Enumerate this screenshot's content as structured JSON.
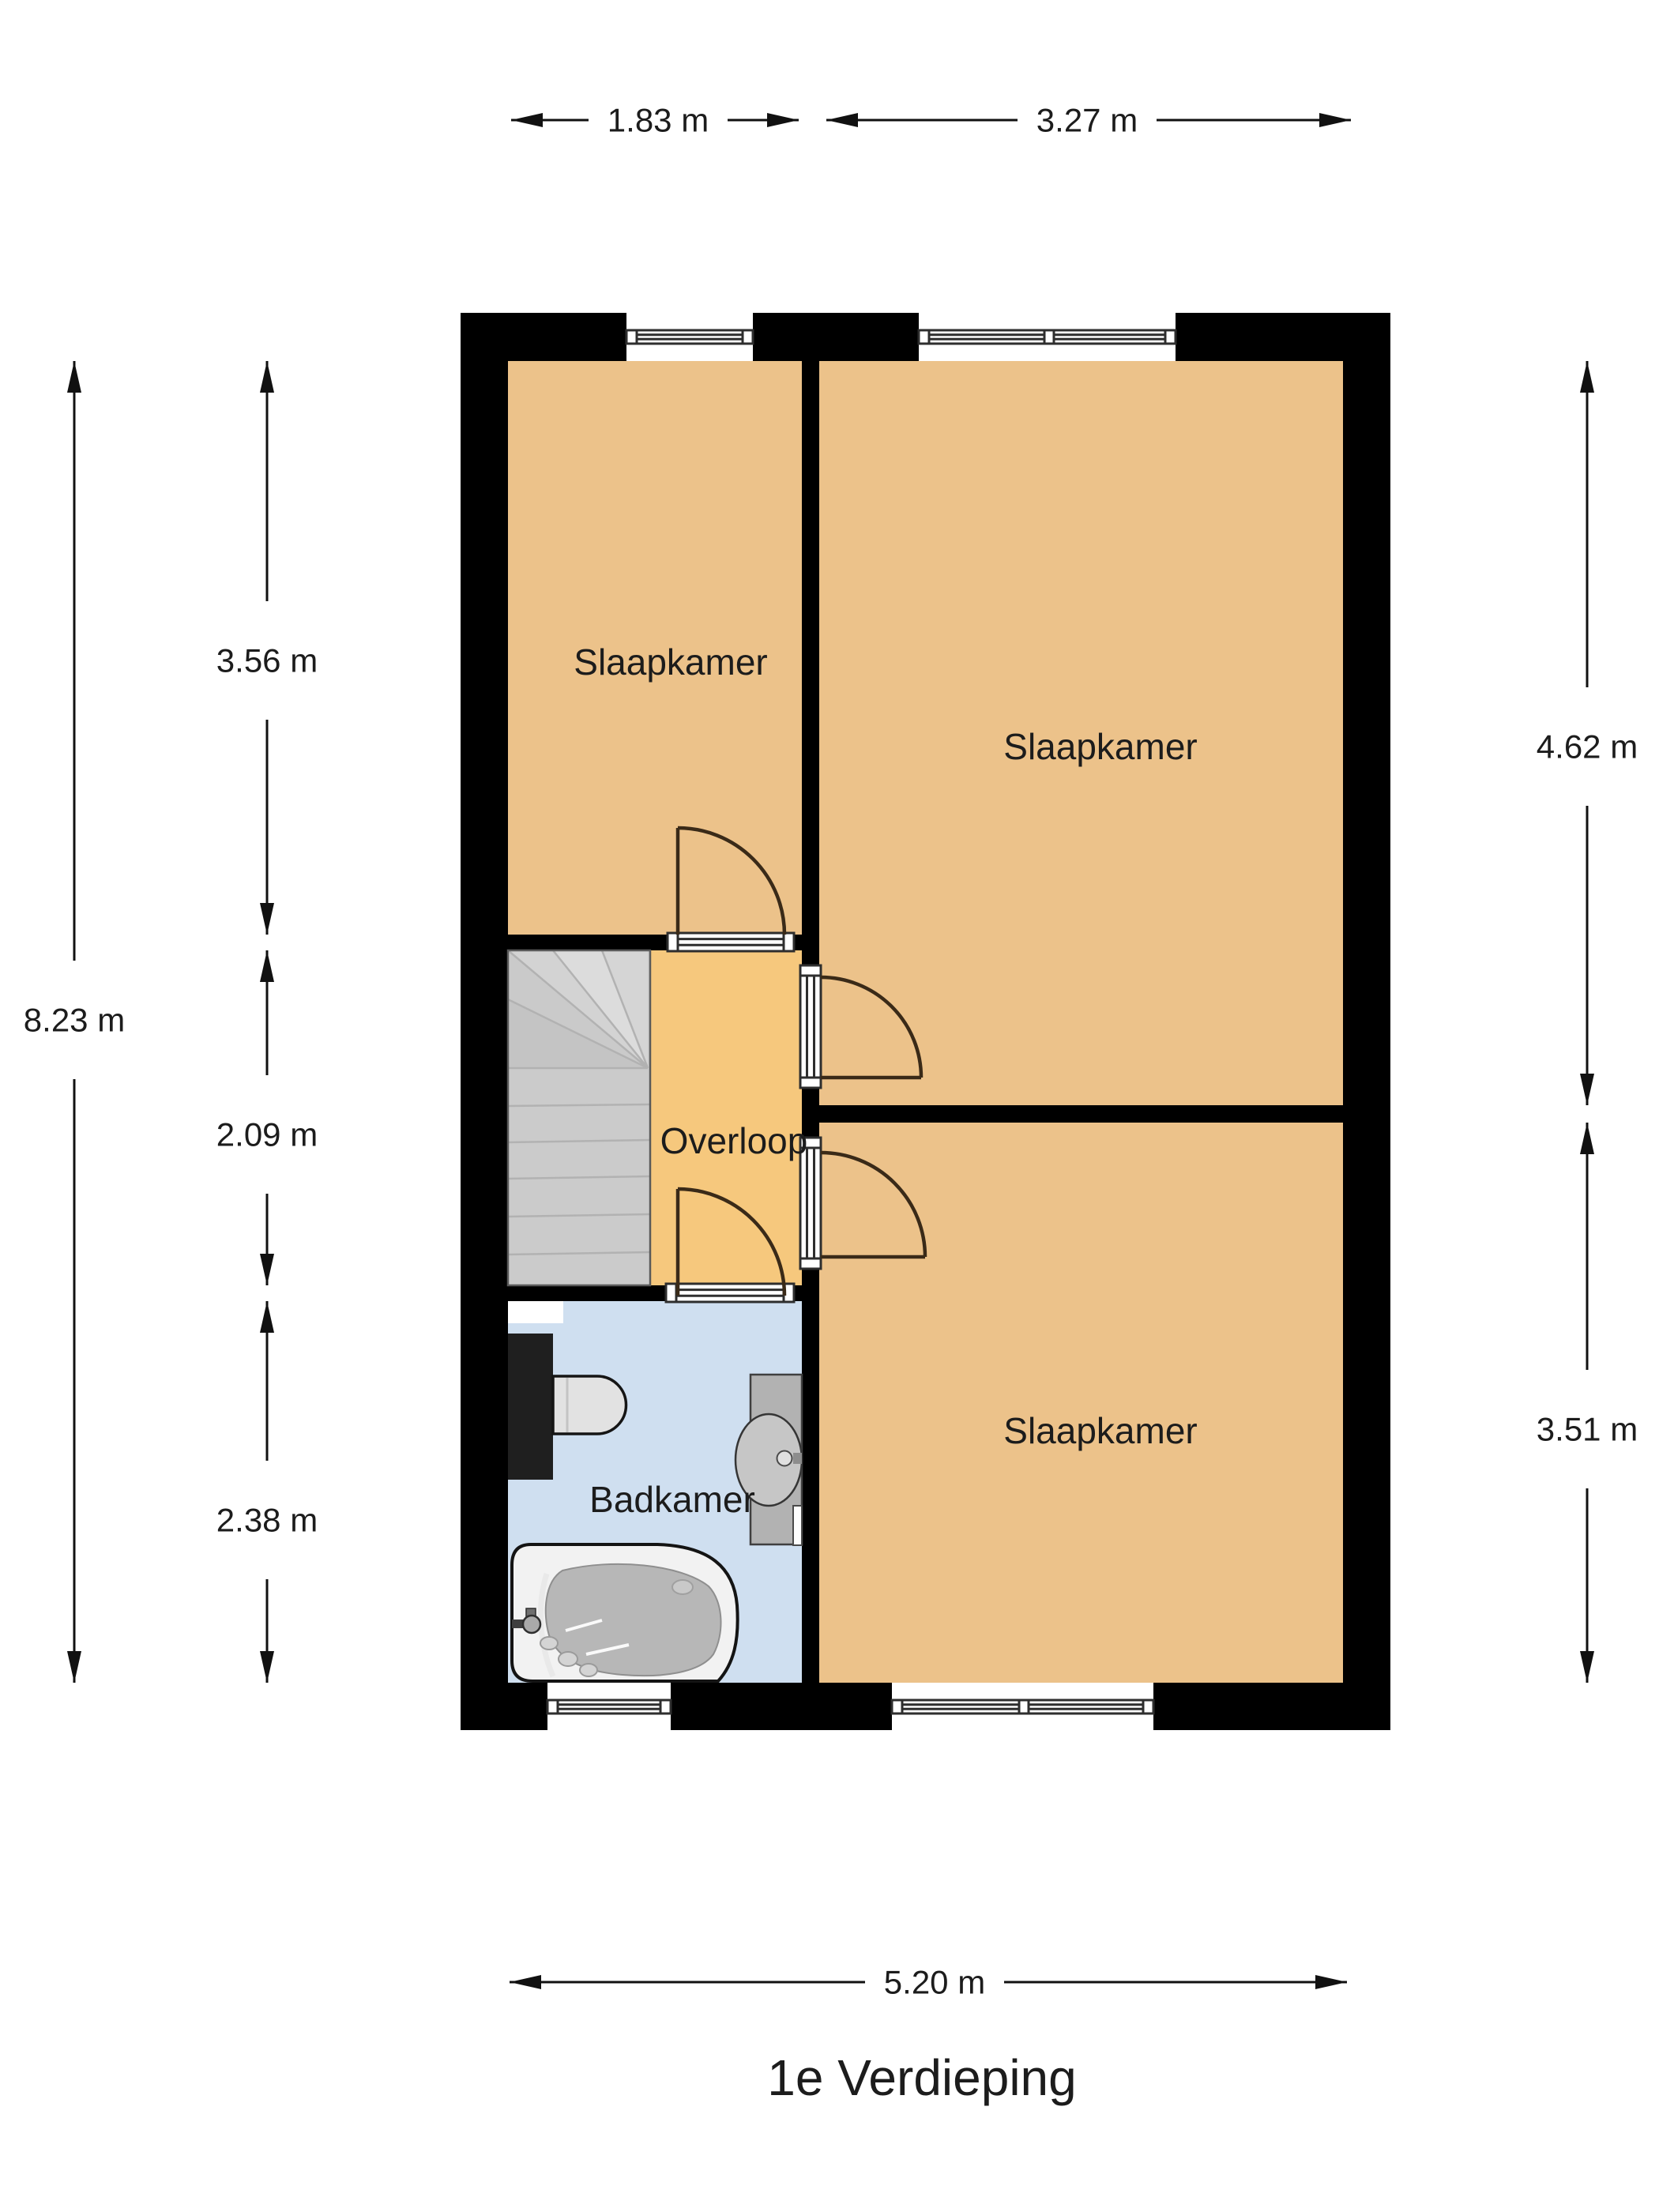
{
  "title": "1e Verdieping",
  "rooms": {
    "slaapkamer_tl": "Slaapkamer",
    "slaapkamer_tr": "Slaapkamer",
    "slaapkamer_br": "Slaapkamer",
    "overloop": "Overloop",
    "badkamer": "Badkamer"
  },
  "dimensions": {
    "top_left_width": "1.83 m",
    "top_right_width": "3.27 m",
    "total_height": "8.23 m",
    "room_tl_height": "3.56 m",
    "overloop_height": "2.09 m",
    "badkamer_height": "2.38 m",
    "room_tr_height": "4.62 m",
    "room_br_height": "3.51 m",
    "total_width": "5.20 m"
  },
  "colors": {
    "wall": "#000000",
    "bedroom_floor": "#ecc28a",
    "overloop_floor": "#f6c87d",
    "bathroom_floor": "#cfdff0",
    "stairs_base": "#cbcbcb",
    "door_arc": "#3a2a18",
    "dimension_line": "#111111"
  }
}
